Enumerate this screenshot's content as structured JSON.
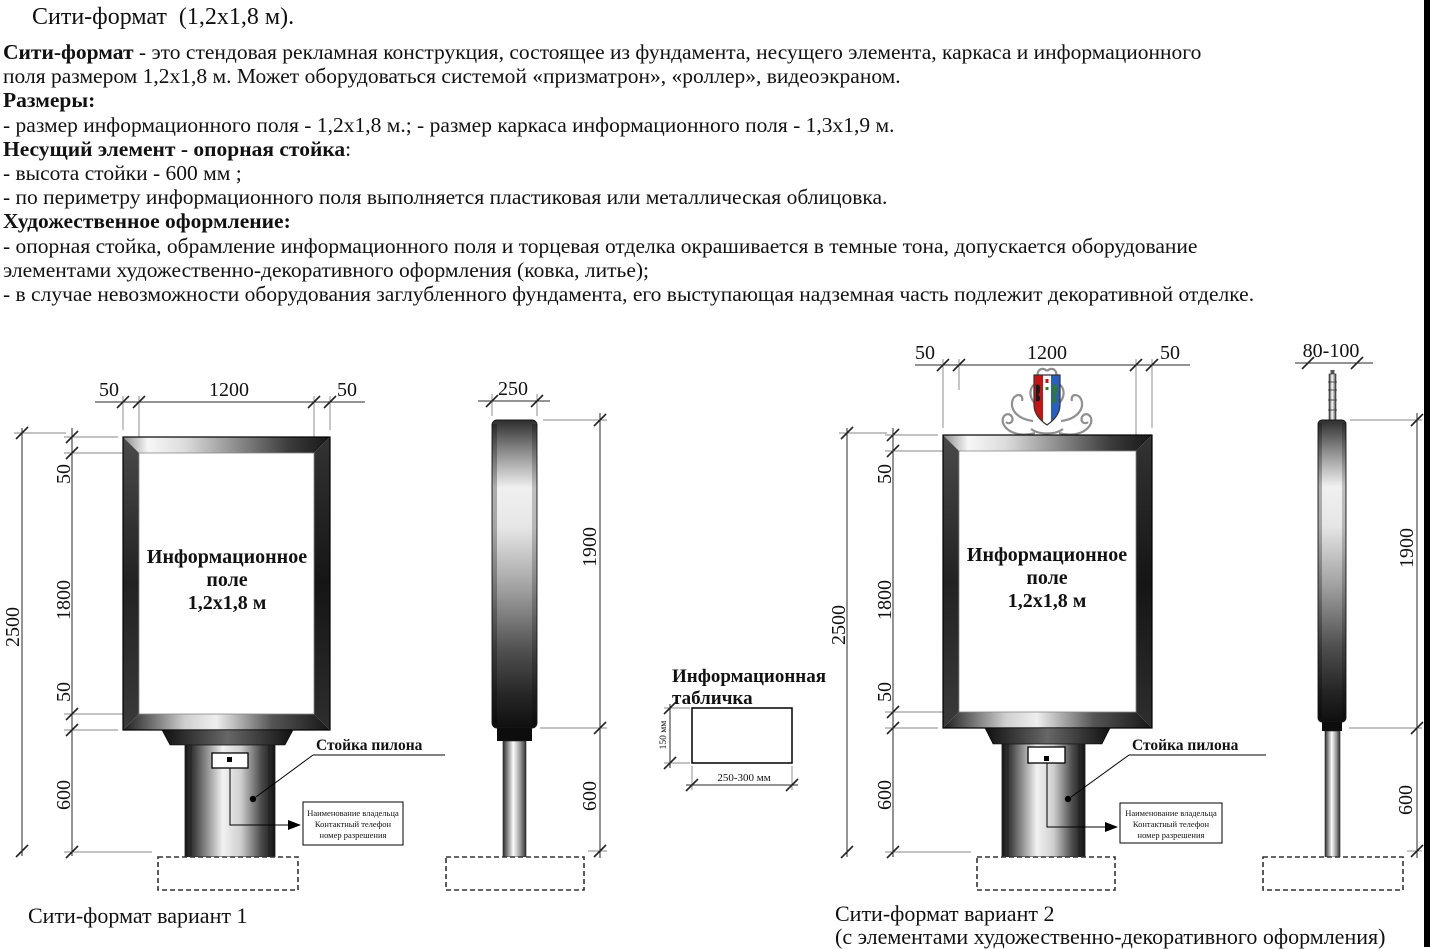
{
  "header": {
    "title": "Сити-формат  (1,2х1,8 м)."
  },
  "description": {
    "intro_bold": "Сити-формат",
    "intro_rest": " - это стендовая рекламная конструкция, состоящее из фундамента, несущего элемента, каркаса и информационного",
    "intro_line2": "поля размером 1,2х1,8 м. Может оборудоваться системой «призматрон», «роллер», видеоэкраном.",
    "sizes_heading": "Размеры:",
    "sizes_line": "- размер информационного поля - 1,2х1,8 м.; - размер каркаса информационного поля - 1,3х1,9 м.",
    "support_heading": "Несущий элемент - опорная стойка",
    "support_heading_colon": ":",
    "support_line1": "- высота стойки - 600 мм ;",
    "support_line2": "- по периметру информационного поля выполняется пластиковая или металлическая облицовка.",
    "art_heading": "Художественное оформление:",
    "art_line1": "- опорная стойка, обрамление информационного поля и торцевая отделка окрашивается в темные тона, допускается оборудование",
    "art_line2": "элементами художественно-декоративного оформления (ковка, литье);",
    "art_line3": "- в случае невозможности оборудования заглубленного фундамента, его выступающая надземная часть подлежит декоративной отделке."
  },
  "variant1": {
    "caption": "Сити-формат вариант 1",
    "dim_top_left": "50",
    "dim_top_width": "1200",
    "dim_top_right": "50",
    "dim_total": "2500",
    "dim_frame_top": "50",
    "dim_field": "1800",
    "dim_frame_bottom": "50",
    "dim_stand": "600",
    "panel_line1": "Информационное",
    "panel_line2": "поле",
    "panel_line3": "1,2х1,8 м",
    "pylon_label": "Стойка пилона",
    "plate_line1": "Наименование владельца",
    "plate_line2": "Контактный телефон",
    "plate_line3": "номер разрешения"
  },
  "side1": {
    "dim_width": "250",
    "dim_panel": "1900",
    "dim_stand": "600"
  },
  "info_plate": {
    "title_line1": "Информационная",
    "title_line2": "табличка",
    "dim_height": "150 мм",
    "dim_width": "250-300 мм"
  },
  "variant2": {
    "caption": "Сити-формат вариант 2",
    "caption_note": "(с элементами художественно-декоративного оформления)",
    "dim_top_left": "50",
    "dim_top_width": "1200",
    "dim_top_right": "50",
    "dim_total": "2500",
    "dim_frame_top": "50",
    "dim_field": "1800",
    "dim_frame_bottom": "50",
    "dim_stand": "600",
    "panel_line1": "Информационное",
    "panel_line2": "поле",
    "panel_line3": "1,2х1,8 м",
    "pylon_label": "Стойка пилона",
    "plate_line1": "Наименование владельца",
    "plate_line2": "Контактный телефон",
    "plate_line3": "номер разрешения",
    "crest": {
      "red": "#c41414",
      "white": "#ffffff",
      "blue": "#2a5fc2",
      "figure_dark": "#1a1a1a",
      "figure_green": "#2e7d1e",
      "scroll": "#8f8f8f"
    }
  },
  "side2": {
    "dim_width": "80-100",
    "dim_panel": "1900",
    "dim_stand": "600"
  }
}
